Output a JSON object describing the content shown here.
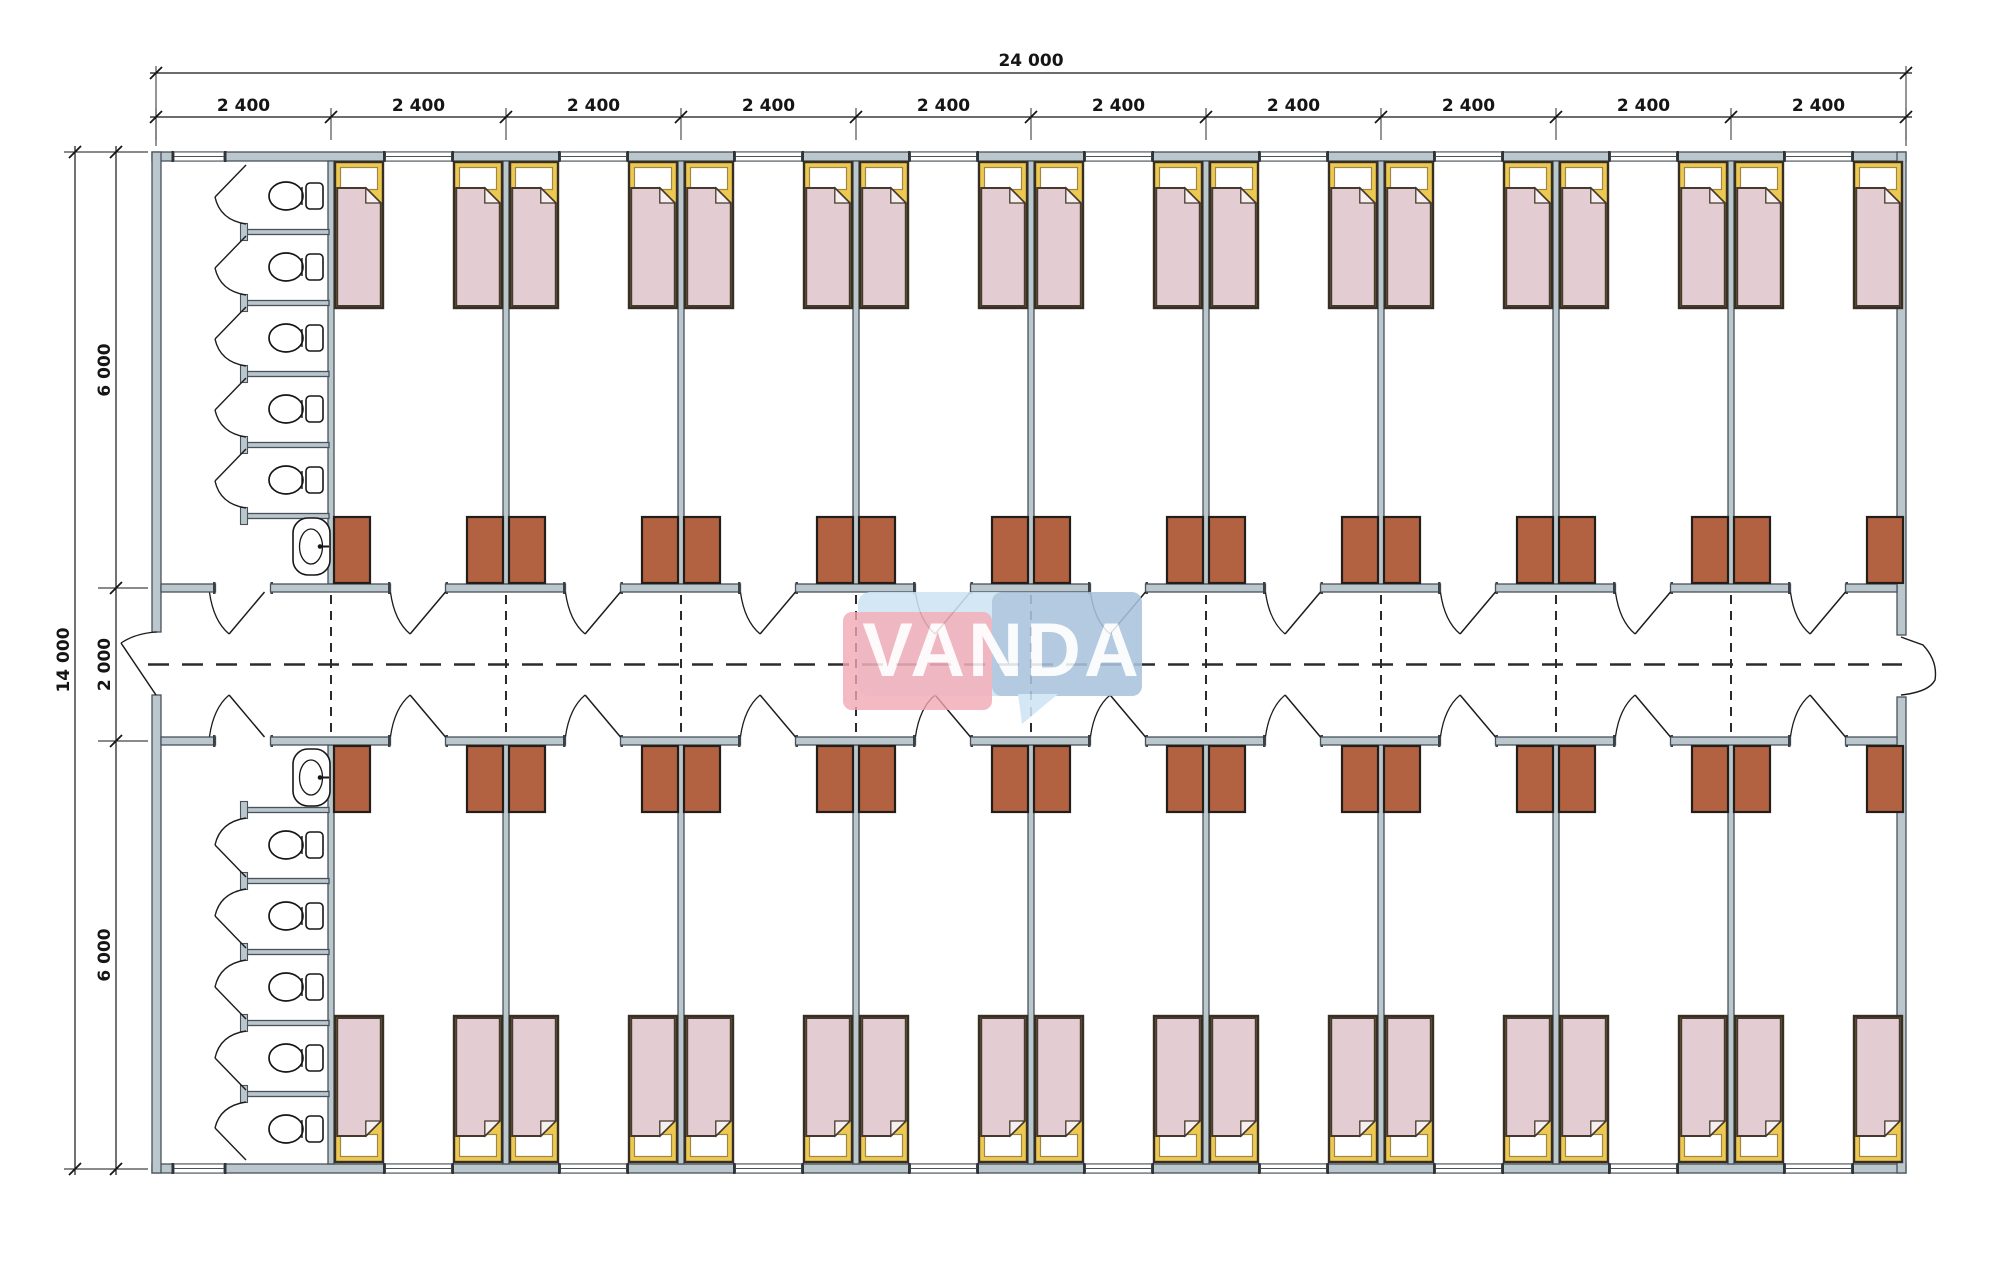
{
  "drawing": {
    "title": "modular dormitory floor plan",
    "dimensions": {
      "top_total": "24 000",
      "top_segments": [
        "2 400",
        "2 400",
        "2 400",
        "2 400",
        "2 400",
        "2 400",
        "2 400",
        "2 400",
        "2 400",
        "2 400"
      ],
      "left_total": "14 000",
      "left_segments": [
        "6 000",
        "2 000",
        "6 000"
      ]
    },
    "watermark": {
      "text": "VANDA",
      "pink": "#f0a7b2",
      "light_blue": "#cfe4f3",
      "dark_blue": "#a9c3dc",
      "text_color": "#ffffff"
    },
    "plan": {
      "bays": 10,
      "room_bays_per_wing": 9,
      "wings": 2,
      "beds_per_room": 2,
      "wardrobes_per_room": 2,
      "toilet_stalls_per_block": 5,
      "sinks_per_block": 1,
      "colors": {
        "wall_fill": "#bac7cd",
        "wall_edge": "#49525a",
        "line": "#1c1c1c",
        "bed_yellow": "#eec951",
        "bed_border": "#372f24",
        "pillow": "#ffffff",
        "pillow_edge": "#9c8747",
        "blanket": "#e3ccd2",
        "blanket_edge": "#453a2d",
        "fold": "#f7eef0",
        "wardrobe": "#b26241",
        "wardrobe_edge": "#231e19",
        "fixture": "#161616",
        "dash": "#2b2b2b",
        "dim": "#151515",
        "window_fill": "#ffffff"
      }
    }
  }
}
